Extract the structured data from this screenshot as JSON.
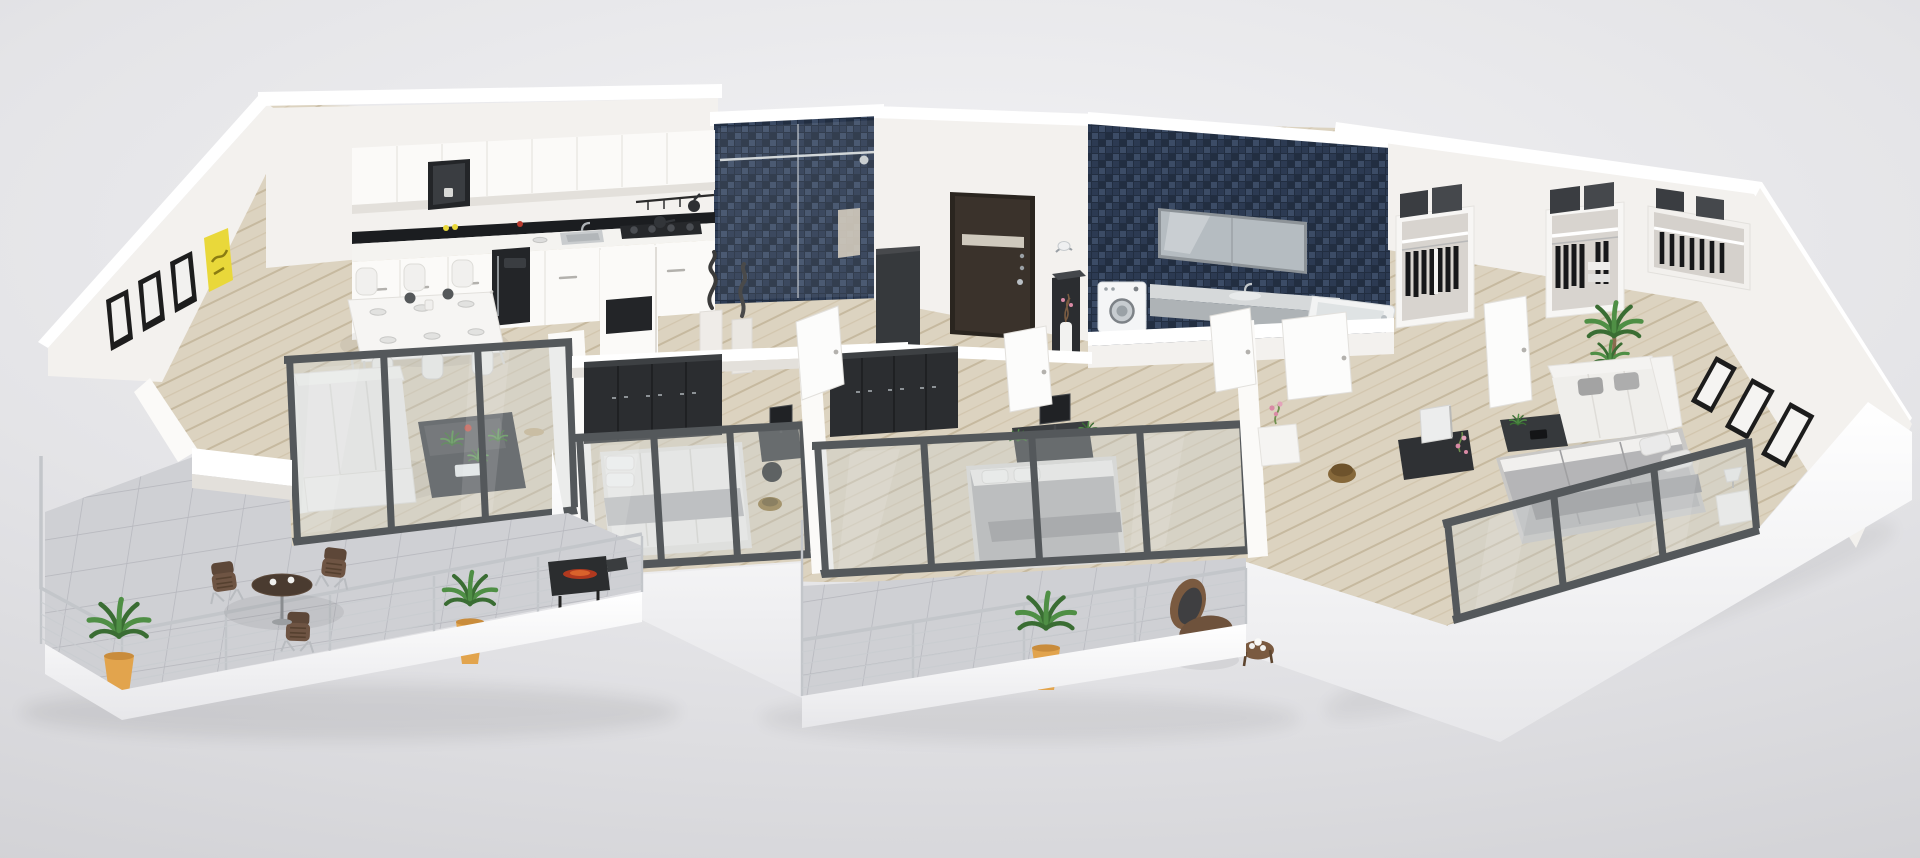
{
  "scene": {
    "type": "3d-floor-plan-render",
    "description": "photorealistic 3d cutaway floor plan of an apartment seen from an elevated oblique angle, no visible text",
    "background": {
      "top": "#f2f2f4",
      "mid": "#e4e4e7",
      "bottom": "#cdcdd1"
    }
  },
  "palette": {
    "wall_white": "#fbfaf8",
    "wall_face": "#f3f1ee",
    "wall_shadow": "#e3e0db",
    "wood_floor": "#dcd3c0",
    "wood_line": "#c6b99f",
    "tile_floor": "#cfd0d4",
    "tile_line": "#b7b8be",
    "mosaic_navy": "#2c3a52",
    "mosaic_deep": "#222e41",
    "mosaic_light": "#3c4c66",
    "glass_tint": "#c9d0d1",
    "frame_metal": "#54585b",
    "railing_metal": "#c3c6ca",
    "furniture_dark": "#36393c",
    "wardrobe_dark": "#2b2d30",
    "entry_door": "#3a322b",
    "sofa_white": "#f1f0ee",
    "bed_gray": "#b5b5b7",
    "counter_white": "#f4f3f0",
    "backsplash_black": "#1b1d20",
    "plant_green": "#4f8f45",
    "plant_deep": "#3a6d33",
    "pot_orange": "#e2a44d",
    "outdoor_brown": "#6b5242",
    "accent_yellow": "#e9d83a"
  },
  "rooms": [
    {
      "id": "kitchen",
      "furniture": [
        "upper-cabinets",
        "open-shelf-black",
        "black-backsplash",
        "countertop",
        "sink",
        "gas-cooktop",
        "utensil-rail",
        "base-cabinets",
        "tall-black-appliance-column",
        "return-counter"
      ]
    },
    {
      "id": "dining-area",
      "furniture": [
        "white-dining-table",
        "white-chairs-x6",
        "place-settings",
        "dark-centerpieces"
      ]
    },
    {
      "id": "living-room",
      "furniture": [
        "white-corner-sofa",
        "dark-coffee-table",
        "potted-plants",
        "red-flower",
        "glass-sliding-wall"
      ]
    },
    {
      "id": "terrace-left",
      "furniture": [
        "cable-railing",
        "round-bistro-table",
        "bistro-chairs-x3",
        "barbecue-grill",
        "potted-plants-x2",
        "white-cups-x2"
      ]
    },
    {
      "id": "shower-room",
      "furniture": [
        "navy-mosaic-tiling",
        "glass-shower-screen",
        "chrome-rail",
        "towel"
      ]
    },
    {
      "id": "entry",
      "furniture": [
        "dark-entry-door-with-glass-strip",
        "dark-console-table",
        "white-vase",
        "wall-sconce",
        "dark-storage-cabinet"
      ]
    },
    {
      "id": "hallway",
      "furniture": [
        "abstract-sculptures-x2",
        "white-open-doors-x5",
        "gold-drum-table",
        "white-console-with-pink-flowers"
      ]
    },
    {
      "id": "bedroom-1",
      "furniture": [
        "black-wardrobe",
        "double-bed-white-bedding",
        "gray-throw",
        "small-desk-with-monitor",
        "brass-hamper",
        "glass-window-wall"
      ]
    },
    {
      "id": "bedroom-2",
      "furniture": [
        "black-wardrobe",
        "double-bed-gray-bedding",
        "desk-with-monitor",
        "office-chair",
        "desk-plants",
        "glass-sliding-wall"
      ]
    },
    {
      "id": "bathroom",
      "furniture": [
        "navy-mosaic-wall",
        "wide-mirror",
        "gray-vanity-counter",
        "basin",
        "washing-machine",
        "bathtub",
        "white-half-wall"
      ]
    },
    {
      "id": "walk-in-closet",
      "furniture": [
        "open-shelving-units-x3",
        "hanging-black-clothes",
        "dark-storage-boxes",
        "white-open-door"
      ]
    },
    {
      "id": "lounge",
      "furniture": [
        "white-sofa-gray-cushions",
        "dark-coffee-tables",
        "palm-plant",
        "media-console",
        "white-tv-panel",
        "pink-orchid"
      ]
    },
    {
      "id": "bedroom-3",
      "furniture": [
        "double-bed-gray-bedding",
        "white-pillows",
        "white-nightstand",
        "table-lamp",
        "glass-sliding-wall"
      ]
    },
    {
      "id": "terrace-right",
      "furniture": [
        "cable-railing",
        "potted-plant",
        "wicker-rocking-chair",
        "wicker-side-table",
        "coffee-set"
      ]
    }
  ],
  "wall_art": {
    "left_wall_black_frames": 3,
    "right_wall_black_frames": 3,
    "yellow_artwork_panels": 1
  },
  "counts": {
    "terraces": 2,
    "bedrooms": 3,
    "glass_walls": 5,
    "terrace_plants": 3
  }
}
